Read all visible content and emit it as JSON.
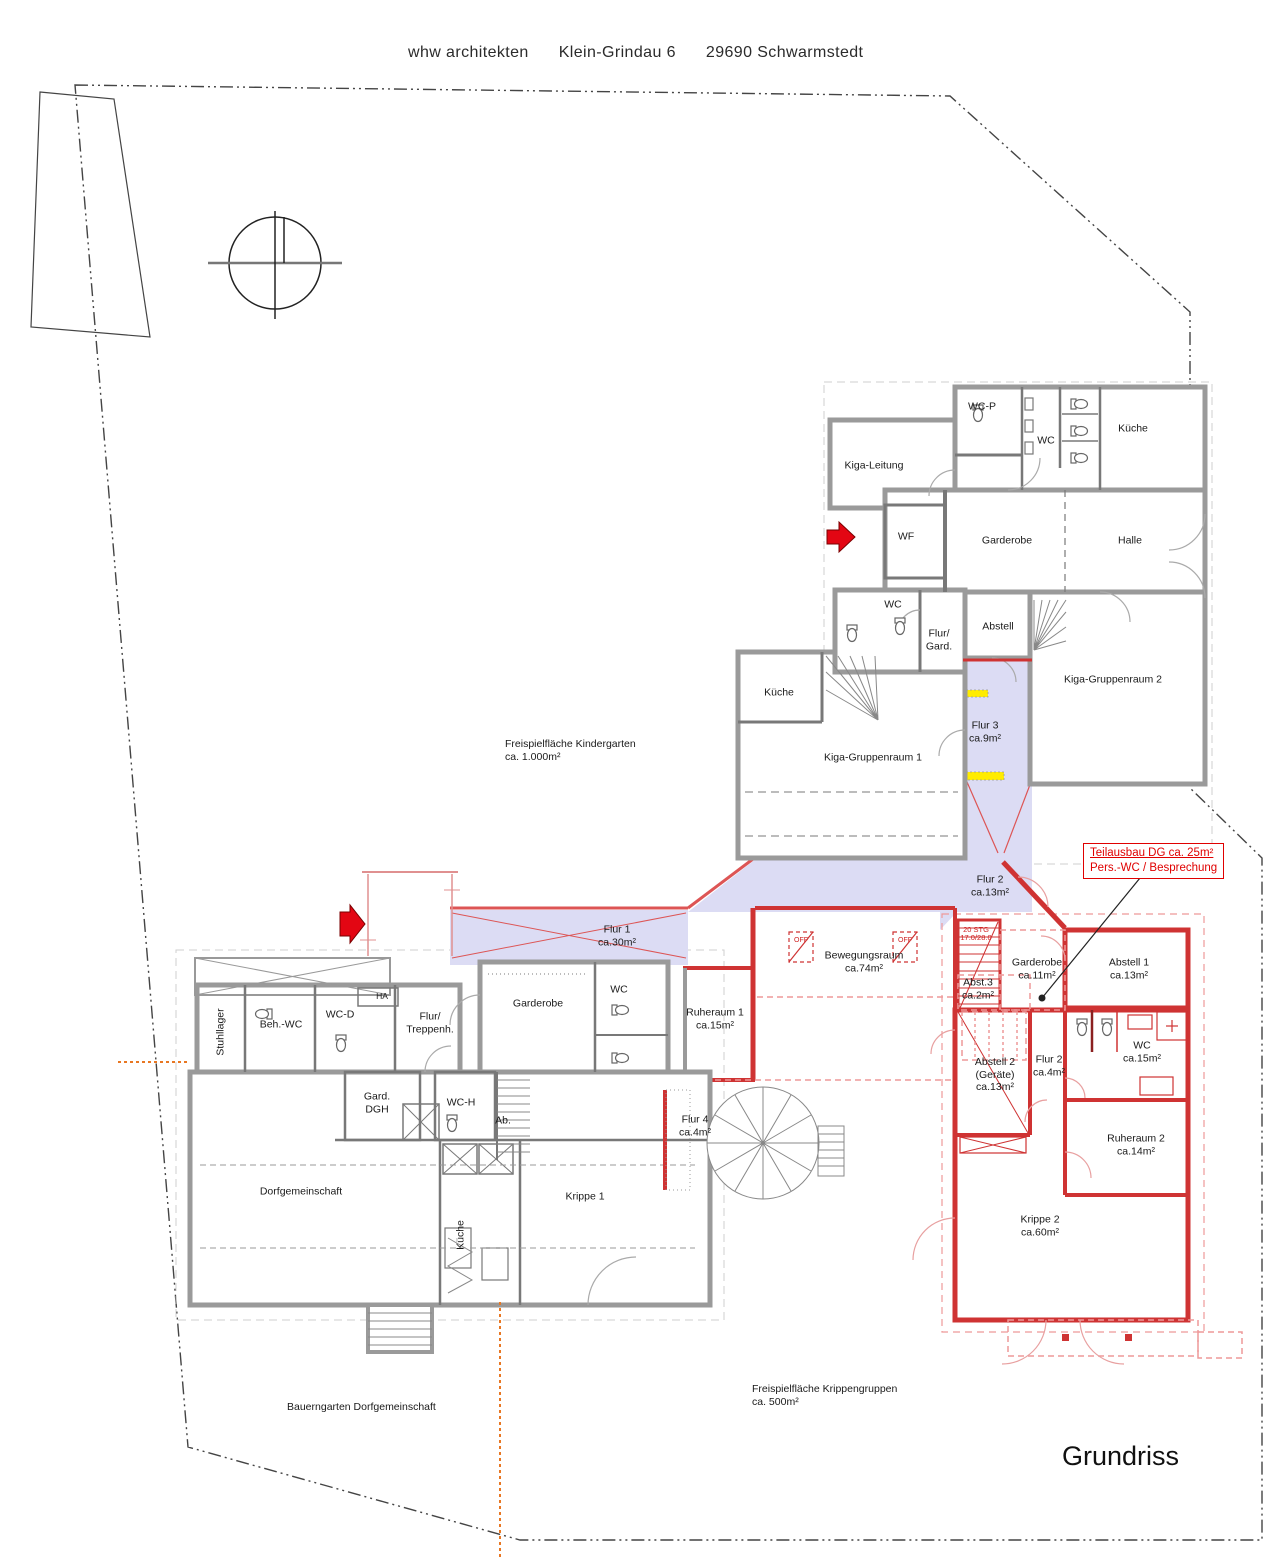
{
  "header": {
    "firm": "whw architekten",
    "address": "Klein-Grindau 6",
    "city": "29690 Schwarmstedt"
  },
  "title": "Grundriss",
  "site_labels": {
    "freispiel_kindergarten": "Freispielfläche Kindergarten\nca. 1.000m²",
    "freispiel_krippe": "Freispielfläche Krippengruppen\nca. 500m²",
    "bauerngarten": "Bauerngarten Dorfgemeinschaft"
  },
  "annotation": {
    "line1": "Teilausbau DG ca. 25m²",
    "line2": "Pers.-WC / Besprechung"
  },
  "stair_note": "20 STG\n17.0/28.0",
  "colors": {
    "existing_wall": "#9a9a9a",
    "new_wall": "#cf3333",
    "corridor": "#dcdcf4",
    "highlight": "#ffec00",
    "entrance_arrow": "#e30613",
    "annotation_red": "#e00000",
    "fence_orange": "#e87722"
  },
  "rooms": {
    "kiga_leitung": "Kiga-Leitung",
    "wc_p": "WC-P",
    "wc_nord": "WC",
    "kueche_og": "Küche",
    "wf": "WF",
    "garderobe_kiga": "Garderobe",
    "halle": "Halle",
    "wc_kiga": "WC",
    "flur_gard": "Flur/\nGard.",
    "abstell_kiga": "Abstell",
    "kiga_gruppenraum_2": "Kiga-Gruppenraum 2",
    "kueche_kiga": "Küche",
    "flur_3": "Flur 3\nca.9m²",
    "kiga_gruppenraum_1": "Kiga-Gruppenraum 1",
    "flur_1": "Flur 1\nca.30m²",
    "flur_2_neu": "Flur 2\nca.13m²",
    "bewegungsraum": "Bewegungsraum\nca.74m²",
    "off_1": "OFF",
    "off_2": "OFF",
    "garderobe_neu": "Garderobe\nca.11m²",
    "abstell_1": "Abstell 1\nca.13m²",
    "abst_3": "Abst.3\nca.2m²",
    "ruheraum_1": "Ruheraum 1\nca.15m²",
    "abstell_2": "Abstell 2\n(Geräte)\nca.13m²",
    "flur_2_klein": "Flur 2\nca.4m²",
    "wc_neu": "WC\nca.15m²",
    "ruheraum_2": "Ruheraum 2\nca.14m²",
    "krippe_2": "Krippe 2\nca.60m²",
    "stuhllager": "Stuhllager",
    "beh_wc": "Beh.-WC",
    "wc_d": "WC-D",
    "ha": "HA",
    "flur_treppenhaus": "Flur/\nTreppenh.",
    "garderobe_dgh": "Garderobe",
    "wc_dgh": "WC",
    "gard_dgh": "Gard.\nDGH",
    "wc_h": "WC-H",
    "ab": "Ab.",
    "dorfgemeinschaft": "Dorfgemeinschaft",
    "kueche_dgh": "Küche",
    "krippe_1": "Krippe 1",
    "flur_4": "Flur 4\nca.4m²"
  }
}
